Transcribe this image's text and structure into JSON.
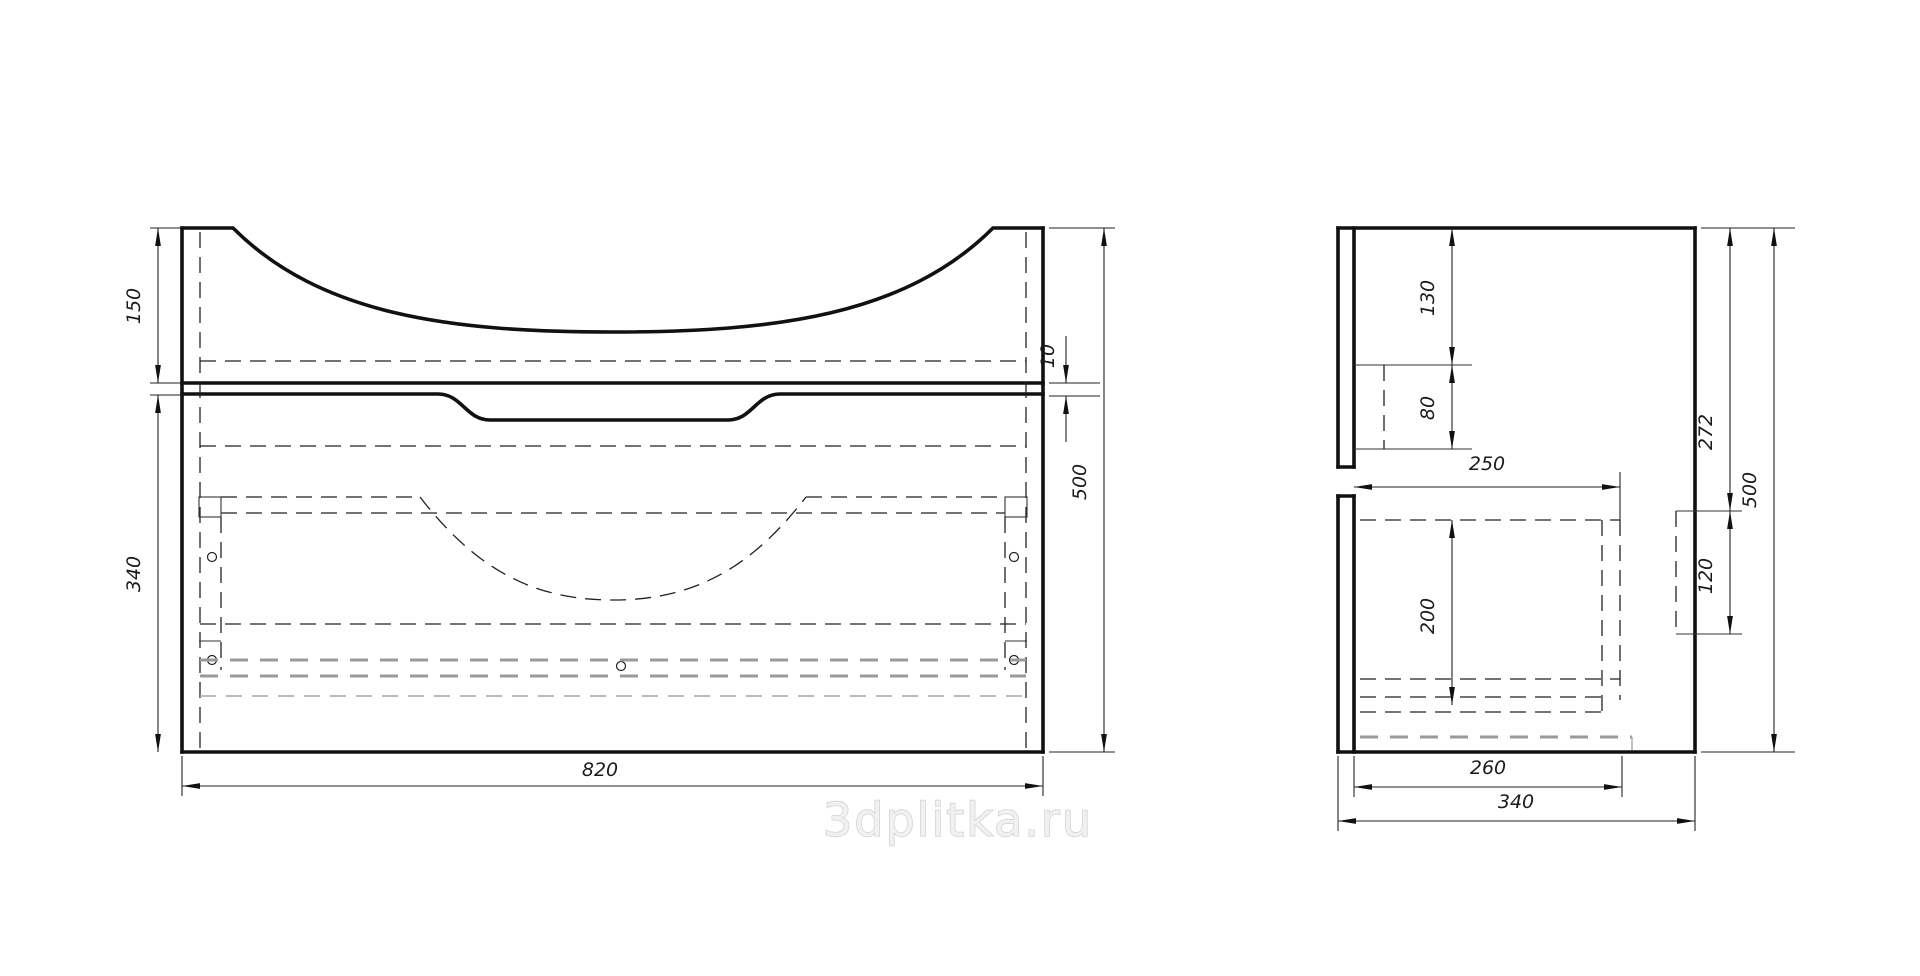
{
  "drawing": {
    "description": "Two-view technical drawing of a wall-hung sink vanity cabinet with drawer",
    "front_view": {
      "width": "820",
      "height": "500",
      "basin_section": "150",
      "drawer_section": "340",
      "gap": "10"
    },
    "side_view": {
      "top_inset": "130",
      "slot_drop": "80",
      "inner_depth": "250",
      "drawer_inner_height": "200",
      "bracket_top_offset": "272",
      "bracket_height": "120",
      "height": "500",
      "bottom_inner_depth": "260",
      "depth": "340"
    },
    "watermark": "3dplitka.ru"
  }
}
